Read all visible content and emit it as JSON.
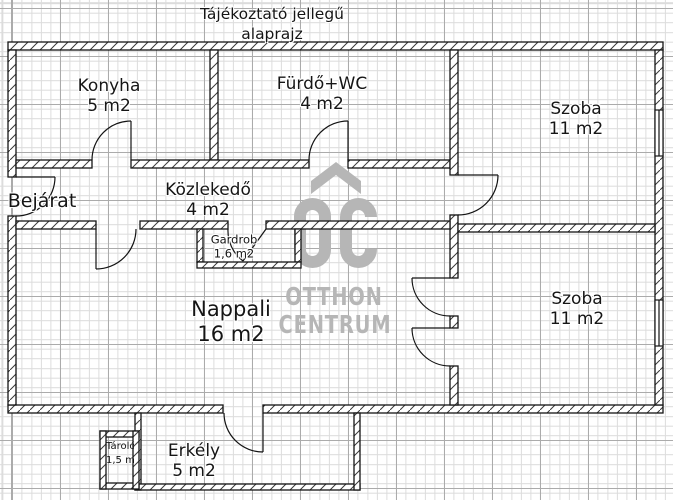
{
  "title": {
    "line1": "Tájékoztató jellegű",
    "line2": "alaprajz"
  },
  "rooms": {
    "konyha": {
      "name": "Konyha",
      "area": "5 m2"
    },
    "furdo": {
      "name": "Fürdő+WC",
      "area": "4 m2"
    },
    "szoba_felso": {
      "name": "Szoba",
      "area": "11 m2"
    },
    "bejarat": {
      "name": "Bejárat"
    },
    "kozlekedo": {
      "name": "Közlekedő",
      "area": "4 m2"
    },
    "gardrob": {
      "name": "Gardrob",
      "area": "1,6 m2"
    },
    "nappali": {
      "name": "Nappali",
      "area": "16 m2"
    },
    "szoba_also": {
      "name": "Szoba",
      "area": "11 m2"
    },
    "erkely": {
      "name": "Erkély",
      "area": "5 m2"
    },
    "tarolo": {
      "name": "Tároló",
      "area": "1,5 m2"
    }
  },
  "watermark": {
    "initials": "OC",
    "line1": "OTTHON",
    "line2": "CENTRUM",
    "color": "#b6b6b6"
  },
  "colors": {
    "wall_line": "#141414",
    "grid_minor": "#dcdcdc",
    "grid_major": "#ababab",
    "background": "#ffffff"
  }
}
